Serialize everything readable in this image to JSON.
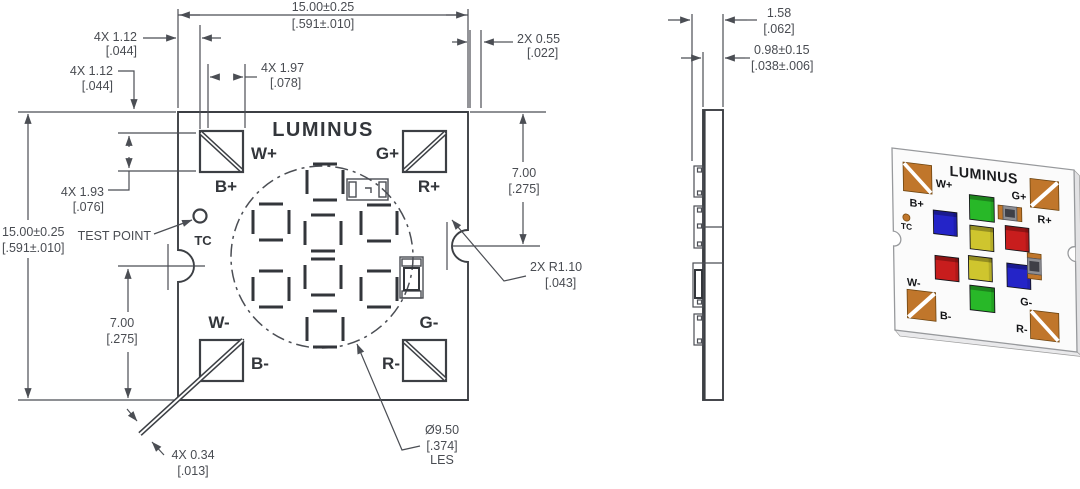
{
  "theme": {
    "line-color": "#4b4e54",
    "text-color": "#494c52",
    "pad-orange": "#c0762b",
    "led-green": "#28b828",
    "led-blue": "#2424c8",
    "led-yellow": "#cfc52e",
    "led-red": "#c81d1d",
    "board-white": "#fbfbfb",
    "bg": "#ffffff"
  },
  "front_view": {
    "brand": "LUMINUS",
    "test_point_label": "TEST POINT",
    "tc_label": "TC",
    "pads": {
      "tl": "W+",
      "tl_b": "B+",
      "tr": "G+",
      "tr_b": "R+",
      "bl_a": "W-",
      "bl": "B-",
      "br_a": "G-",
      "br": "R-"
    },
    "dims": {
      "width": [
        "15.00±0.25",
        "[.591±.010]"
      ],
      "height": [
        "15.00±0.25",
        "[.591±.010]"
      ],
      "pad_inset_top": [
        "4X 1.12",
        "[.044]"
      ],
      "pad_inset_side": [
        "4X 1.12",
        "[.044]"
      ],
      "pad_pitch": [
        "4X 1.97",
        "[.078]"
      ],
      "pad_height": [
        "4X 1.93",
        "[.076]"
      ],
      "edge_gap": [
        "2X 0.55",
        "[.022]"
      ],
      "notch_from_top": [
        "7.00",
        "[.275]"
      ],
      "notch_from_bottom": [
        "7.00",
        "[.275]"
      ],
      "trace_width": [
        "4X 0.34",
        "[.013]"
      ],
      "notch_radius": [
        "2X R1.10",
        "[.043]"
      ],
      "les_diameter": [
        "Ø9.50",
        "[.374]",
        "LES"
      ]
    }
  },
  "side_view": {
    "dims": {
      "total_thickness": [
        "1.58",
        "[.062]"
      ],
      "substrate_thickness": [
        "0.98±0.15",
        "[.038±.006]"
      ]
    }
  },
  "photo_view": {
    "brand": "LUMINUS",
    "tc_label": "TC",
    "pads": {
      "tl": "W+",
      "tl_b": "B+",
      "tr": "G+",
      "tr_b": "R+",
      "bl_a": "W-",
      "bl": "B-",
      "br_a": "G-",
      "br": "R-"
    },
    "led_layout": [
      {
        "position": "top-center",
        "color": "green"
      },
      {
        "position": "row2-left",
        "color": "blue"
      },
      {
        "position": "row2-center",
        "color": "yellow"
      },
      {
        "position": "row2-right",
        "color": "red"
      },
      {
        "position": "row3-left",
        "color": "red"
      },
      {
        "position": "row3-center",
        "color": "yellow"
      },
      {
        "position": "row3-right",
        "color": "blue"
      },
      {
        "position": "bottom-center",
        "color": "green"
      }
    ]
  }
}
